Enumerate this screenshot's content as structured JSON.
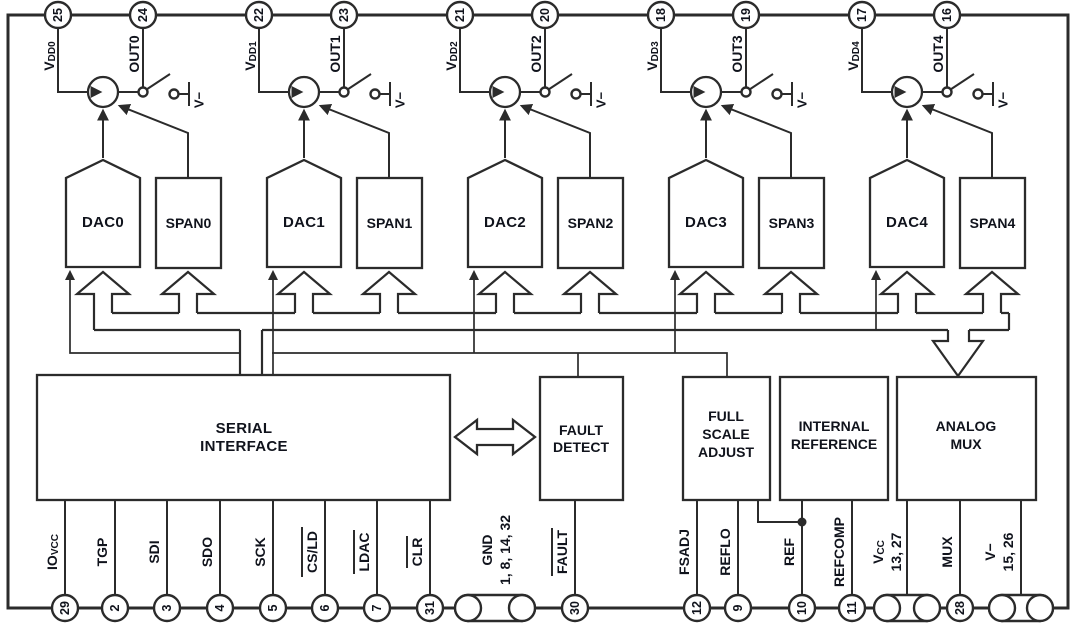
{
  "chip": {
    "switch_rail_label": "V−",
    "channels": [
      {
        "vdd_main": "V",
        "vdd_sub": "DD0",
        "vdd_pin": "25",
        "out_label": "OUT0",
        "out_pin": "24",
        "dac_label": "DAC0",
        "span_label": "SPAN0"
      },
      {
        "vdd_main": "V",
        "vdd_sub": "DD1",
        "vdd_pin": "22",
        "out_label": "OUT1",
        "out_pin": "23",
        "dac_label": "DAC1",
        "span_label": "SPAN1"
      },
      {
        "vdd_main": "V",
        "vdd_sub": "DD2",
        "vdd_pin": "21",
        "out_label": "OUT2",
        "out_pin": "20",
        "dac_label": "DAC2",
        "span_label": "SPAN2"
      },
      {
        "vdd_main": "V",
        "vdd_sub": "DD3",
        "vdd_pin": "18",
        "out_label": "OUT3",
        "out_pin": "19",
        "dac_label": "DAC3",
        "span_label": "SPAN3"
      },
      {
        "vdd_main": "V",
        "vdd_sub": "DD4",
        "vdd_pin": "17",
        "out_label": "OUT4",
        "out_pin": "16",
        "dac_label": "DAC4",
        "span_label": "SPAN4"
      }
    ],
    "blocks": {
      "serial_interface": {
        "line1": "SERIAL",
        "line2": "INTERFACE"
      },
      "fault_detect": {
        "line1": "FAULT",
        "line2": "DETECT"
      },
      "full_scale_adjust": {
        "line1": "FULL",
        "line2": "SCALE",
        "line3": "ADJUST"
      },
      "internal_reference": {
        "line1": "INTERNAL",
        "line2": "REFERENCE"
      },
      "analog_mux": {
        "line1": "ANALOG",
        "line2": "MUX"
      }
    },
    "bottom_pins": [
      {
        "main": "IO",
        "sub": "VCC",
        "pin": "29"
      },
      {
        "main": "TGP",
        "pin": "2"
      },
      {
        "main": "SDI",
        "pin": "3"
      },
      {
        "main": "SDO",
        "pin": "4"
      },
      {
        "main": "SCK",
        "pin": "5"
      },
      {
        "main": "CS/LD",
        "pin": "6",
        "overline": true
      },
      {
        "main": "LDAC",
        "pin": "7",
        "overline": true
      },
      {
        "main": "CLR",
        "pin": "31",
        "overline": true
      },
      {
        "main": "GND",
        "line2": "1, 8, 14, 32"
      },
      {
        "main": "FAULT",
        "pin": "30",
        "overline": true
      },
      {
        "main": "FSADJ",
        "pin": "12"
      },
      {
        "main": "REFLO",
        "pin": "9"
      },
      {
        "main": "REF",
        "pin": "10"
      },
      {
        "main": "REFCOMP",
        "pin": "11"
      },
      {
        "main": "V",
        "sub": "CC",
        "line2": "13, 27"
      },
      {
        "main": "MUX",
        "pin": "28"
      },
      {
        "main": "V−",
        "line2": "15, 26"
      }
    ]
  }
}
